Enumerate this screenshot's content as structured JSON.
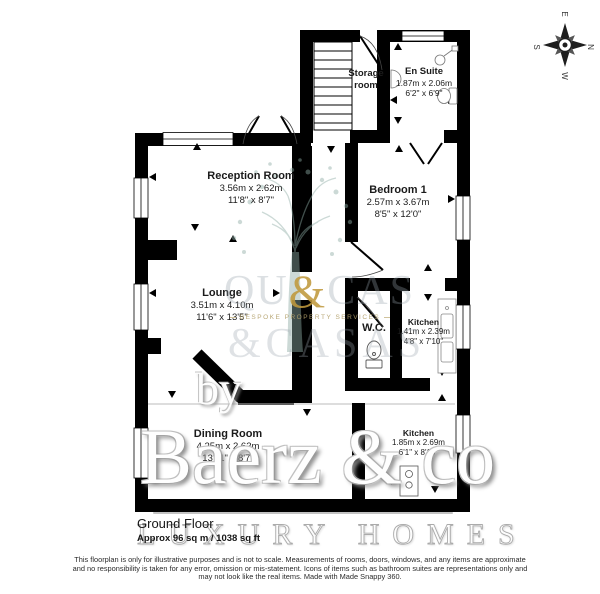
{
  "meta": {
    "floor_label": "Ground Floor",
    "area_label": "Approx 96 sq m / 1038 sq ft"
  },
  "rooms": [
    {
      "name": "Storage room",
      "metric": "",
      "imperial": ""
    },
    {
      "name": "En Suite",
      "metric": "1.87m x 2.06m",
      "imperial": "6'2\" x 6'9\""
    },
    {
      "name": "Reception Room",
      "metric": "3.56m x 2.62m",
      "imperial": "11'8\" x 8'7\""
    },
    {
      "name": "Bedroom 1",
      "metric": "2.57m x 3.67m",
      "imperial": "8'5\" x 12'0\""
    },
    {
      "name": "Lounge",
      "metric": "3.51m x 4.10m",
      "imperial": "11'6\" x 13'5\""
    },
    {
      "name": "W.C.",
      "metric": "",
      "imperial": ""
    },
    {
      "name": "Kitchen",
      "metric": "1.41m x 2.39m",
      "imperial": "4'8\" x 7'10\""
    },
    {
      "name": "Dining Room",
      "metric": "4.25m x 2.62m",
      "imperial": "13'11\" x 8'7\""
    },
    {
      "name": "Kitchen",
      "metric": "1.85m x 2.69m",
      "imperial": "6'1\" x 8'10\""
    }
  ],
  "compass": {
    "north": "N",
    "east": "E",
    "south": "S",
    "west": "W"
  },
  "watermarks": {
    "logo_left": "QU",
    "logo_amp": "&",
    "logo_right": "CAS",
    "logo_tagline": "BESPOKE PROPERTY SERVICES",
    "logo_line2": "&CASAS",
    "by_label": "by",
    "brand": "Baerz & co",
    "brand_sub": "LUXURY HOMES"
  },
  "disclaimer_lines": [
    "This floorplan is only for illustrative purposes and is not to scale. Measurements of rooms, doors, windows, and any items are approximate",
    "and no responsibility is taken for any error, omission or mis-statement. Icons of items such as bathroom suites are representations only and",
    "may not look like the real items. Made with Made Snappy 360."
  ],
  "colors": {
    "wall": "#000000",
    "logo_gold": "#bf983c",
    "tree": "#8fada6"
  }
}
